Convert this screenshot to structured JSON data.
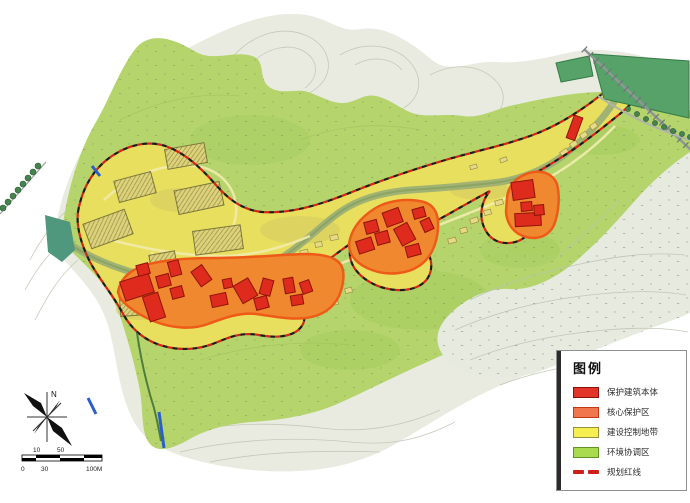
{
  "legend": {
    "title": "图例",
    "items": [
      {
        "label": "保护建筑本体",
        "swatch_color": "#e23428",
        "type": "swatch"
      },
      {
        "label": "核心保护区",
        "swatch_color": "#f1764e",
        "type": "swatch"
      },
      {
        "label": "建设控制地带",
        "swatch_color": "#f5ef52",
        "type": "swatch"
      },
      {
        "label": "环境协调区",
        "swatch_color": "#aada4e",
        "type": "swatch"
      },
      {
        "label": "规划红线",
        "swatch_color": "#cf2018",
        "type": "dashed-line"
      }
    ]
  },
  "compass": {
    "north_label": "N"
  },
  "scale_bar": {
    "upper_labels": [
      "10",
      "50"
    ],
    "lower_labels": [
      "0",
      "30",
      "100M"
    ]
  },
  "map_colors": {
    "protected_building": "#de2b1d",
    "core_protection_zone": "#f0882f",
    "construction_control_zone": "#e9df5e",
    "environment_coordination_zone": "#b5d46c",
    "planning_red_line": "#d92313",
    "river": "#9db074",
    "terrain_contour_area": "#e9ebe0",
    "forest_block": "#57a268",
    "stream_blue": "#2b5fc7"
  }
}
